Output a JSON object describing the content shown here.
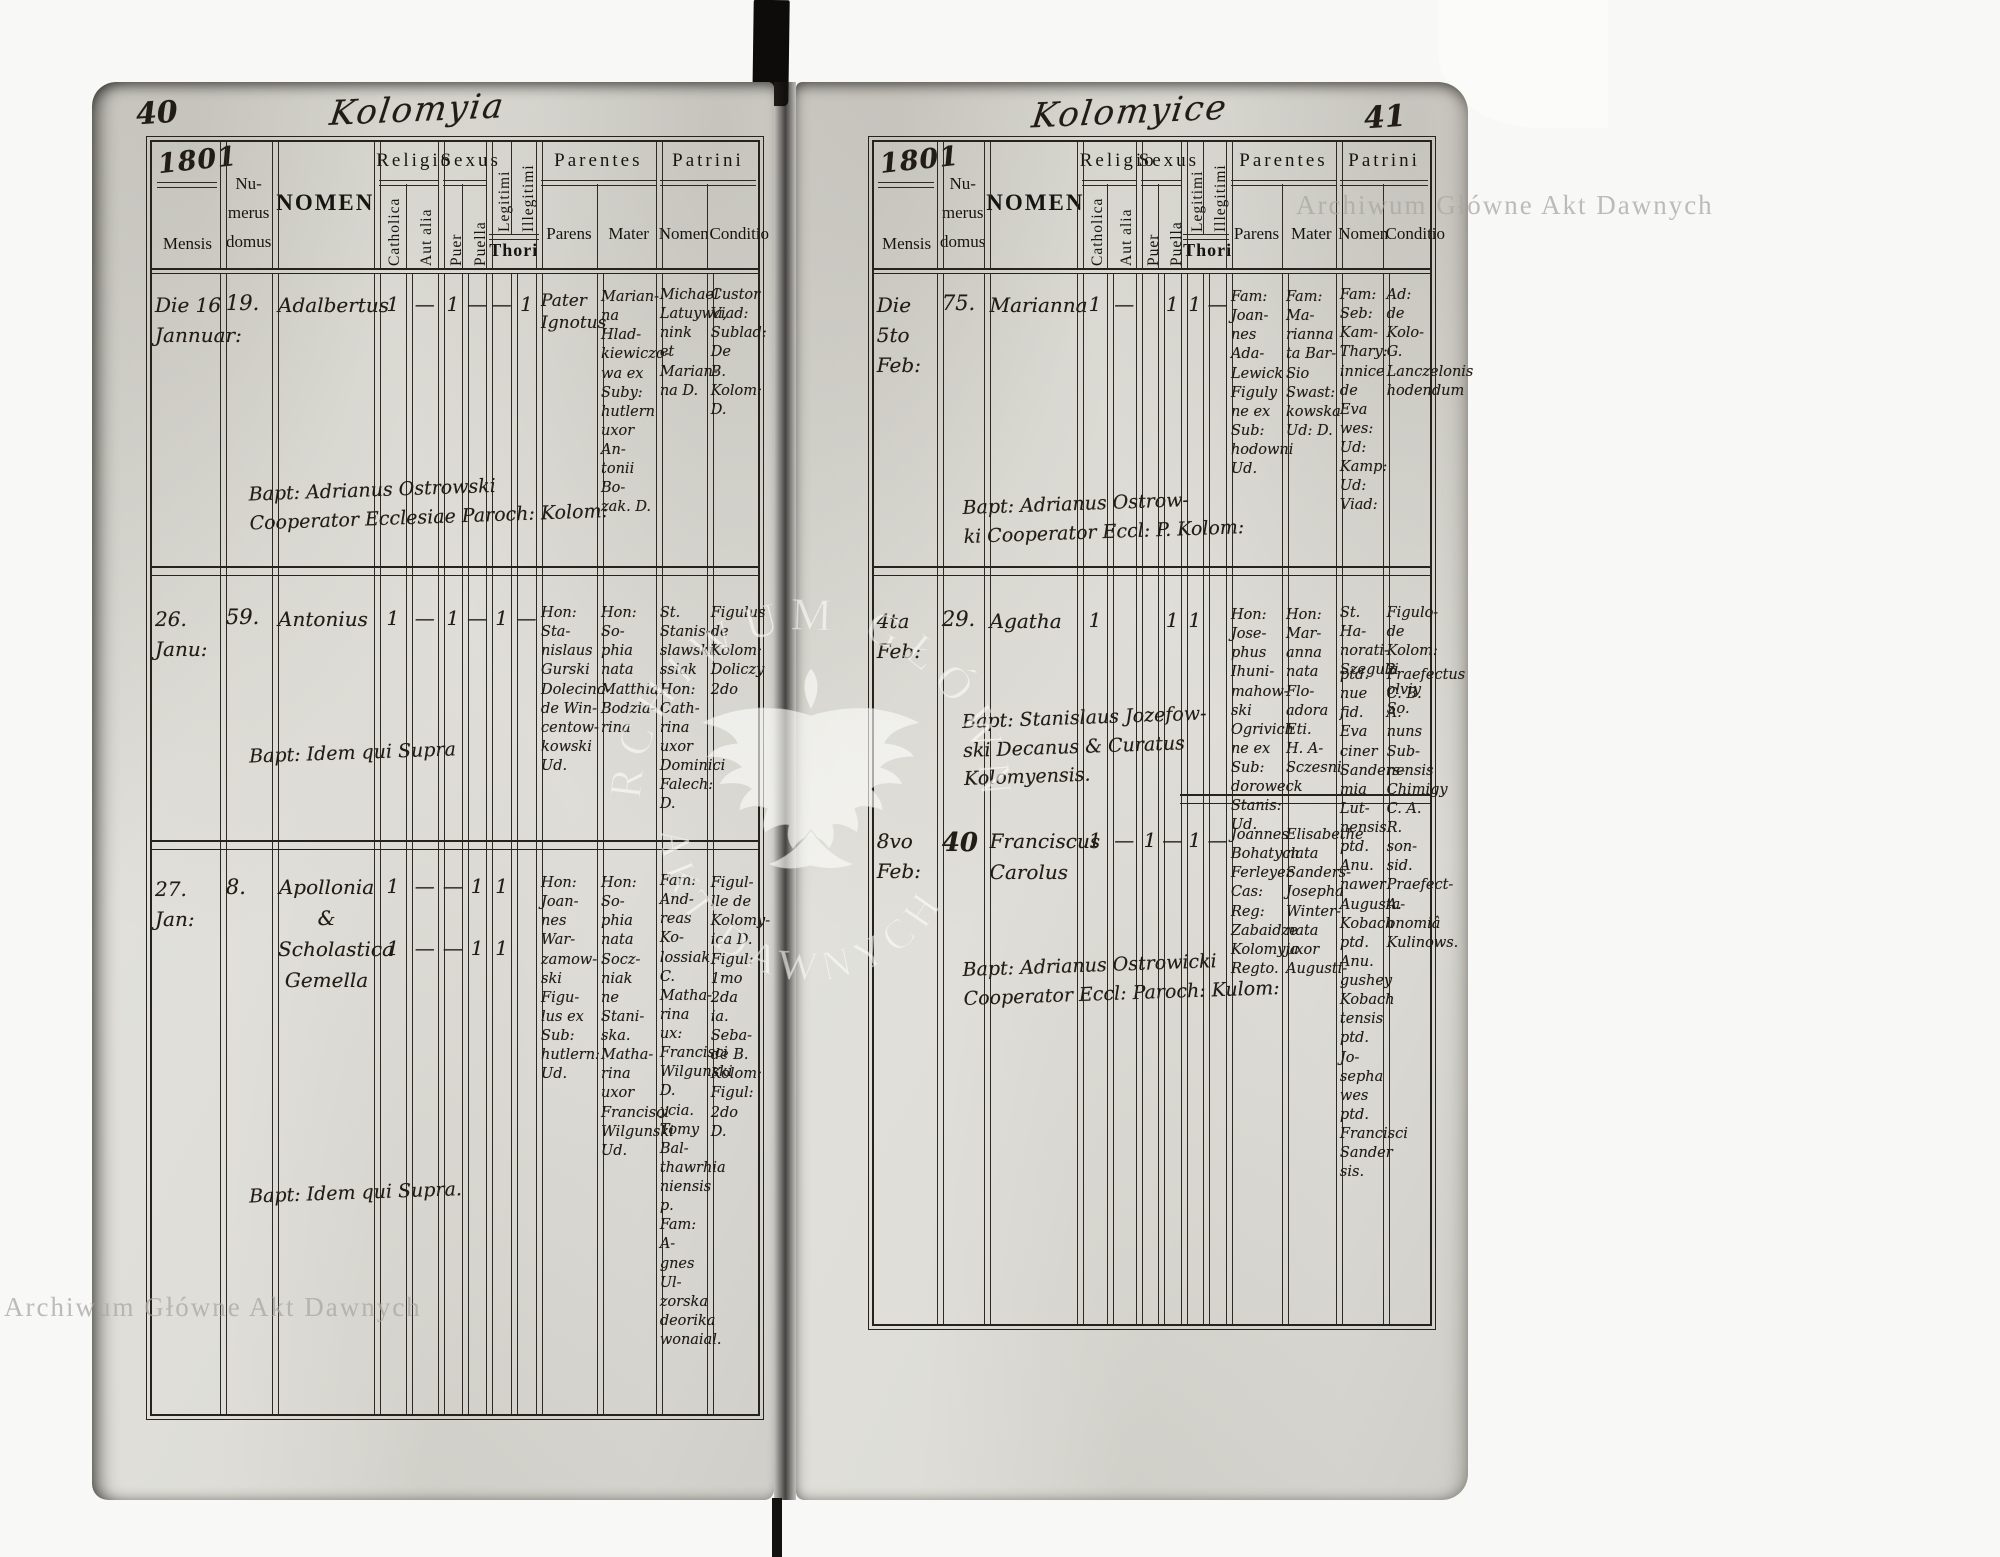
{
  "document": {
    "watermark_text": "Archiwum Główne Akt Dawnych"
  },
  "headers": {
    "mensis": "Mensis",
    "numerus": "Nu-\nmerus\ndomus",
    "nomen": "NOMEN",
    "religio": "Religio",
    "catholica": "Catholica",
    "aut_alia": "Aut alia",
    "sexus": "Sexus",
    "puer": "Puer",
    "puella": "Puella",
    "legitimi": "Legitimi",
    "illegitimi": "Illegitimi",
    "thori": "Thori",
    "parentes": "Parentes",
    "parens": "Parens",
    "mater": "Mater",
    "patrini": "Patrini",
    "patrini_nomen": "Nomen",
    "conditio": "Conditio"
  },
  "left_page": {
    "page_number": "40",
    "title": "Kolomyia",
    "year": "1801",
    "entries": [
      {
        "date": "Die 16\nJannuar:",
        "house": "19.",
        "name": "Adalbertus",
        "marks": {
          "catholica": "1",
          "aut_alia": "—",
          "puer": "1",
          "puella": "—",
          "legitimi": "—",
          "illegitimi": "1"
        },
        "parens": "Pater\nIgnotus",
        "mater": "Marian-\nna Hlad-\nkiewiczo-\nwa ex\nSuby:\nhutlern\nuxor An-\ntonii Bo-\nzak. D.",
        "patrini_nomen": "Michael\nLatuywa,\nnink et\nMarian-\nna D.",
        "patrini_conditio": "Custor\nViad:\nSublad:\nDe\nB. Kolom:\nD.",
        "bapt_note": "Bapt: Adrianus Ostrowski\nCooperator Ecclesiae Paroch: Kolom:"
      },
      {
        "date": "26.\nJanu:",
        "house": "59.",
        "name": "Antonius",
        "marks": {
          "catholica": "1",
          "aut_alia": "—",
          "puer": "1",
          "puella": "—",
          "legitimi": "1",
          "illegitimi": "—"
        },
        "parens": "Hon: Sta-\nnislaus\nGurski\nDolecino-\nde Win-\ncentow-\nkowski\nUd.",
        "mater": "Hon: So-\nphia\nnata\nMatthia\nBodzia-\nrina",
        "patrini_nomen": "St. Stanis-\nslawski\nssiak\nHon: Cath-\nrina uxor\nDominici\nFalech: D.",
        "patrini_conditio": "Figulus\nde\nKolom:\nDoliczy\n2do",
        "bapt_note": "Bapt: Idem qui Supra"
      },
      {
        "date": "27.\nJan:",
        "house": "8.",
        "name": "Apollonia\n&\nScholastica\nGemella",
        "marks": {
          "catholica": "1",
          "aut_alia": "—",
          "puer": "—",
          "puella": "1",
          "legitimi": "1",
          "illegitimi": ""
        },
        "marks2": {
          "catholica": "1",
          "aut_alia": "—",
          "puer": "—",
          "puella": "1",
          "legitimi": "1",
          "illegitimi": ""
        },
        "parens": "Hon: Joan-\nnes War-\nzamow-\nski Figu-\nlus ex\nSub:\nhutlern:\nUd.",
        "mater": "Hon: So-\nphia nata\nSocz-\nniak\nne Stani-\nska.\nMatha-\nrina uxor\nFrancisci\nWilgunski\nUd.",
        "patrini_nomen": "Fam: And-\nreas Ko-\nlossiak C.\nMatha-\nrina ux:\nFrancisci\nWilgunski\nD.\nycia.\nTomy Bal-\nthawrhia\nniensis p.\nFam: A-\ngnes Ul-\nzorska\ndeorika\nwonaial.",
        "patrini_conditio": "Figul-\nlle de\nKolomy-\nica D.\nFigul:\n1mo\n2da\nia.\nSeba-\nde B.\nKolom:\nFigul:\n2do\nD.",
        "bapt_note": "Bapt: Idem qui Supra."
      }
    ]
  },
  "right_page": {
    "page_number": "41",
    "title": "Kolomyice",
    "year": "1801",
    "entries": [
      {
        "date": "Die 5to\nFeb:",
        "house": "75.",
        "name": "Marianna",
        "marks": {
          "catholica": "1",
          "aut_alia": "—",
          "puer": "",
          "puella": "1",
          "legitimi": "1",
          "illegitimi": "—"
        },
        "parens": "Fam: Joan-\nnes Ada-\nLewick\nFiguly\nne ex Sub:\nhodowni\nUd.",
        "mater": "Fam: Ma-\nrianna\nta Bar-\nSio Swast:\nkowska\nUd: D.",
        "patrini_nomen": "Fam: Seb:\nKam-\nThary:\ninnice\nde Eva\nwes: Ud:\nKamp: Ud: Viad:",
        "patrini_conditio": "Ad: de Kolo-\nG.\nLanczelonis\nhodendum",
        "bapt_note": "Bapt: Adrianus Ostrow-\nki Cooperator Eccl: P. Kolom:"
      },
      {
        "date": "4ta\nFeb:",
        "house": "29.",
        "name": "Agatha",
        "marks": {
          "catholica": "1",
          "aut_alia": "",
          "puer": "",
          "puella": "1",
          "legitimi": "1",
          "illegitimi": ""
        },
        "parens": "Hon: Jose-\nphus Ihuni-\nmahow-\nski\nOgrivich\nne ex Sub:\ndoroweck\nStanis: Ud.",
        "mater": "Hon: Mar-\nanna\nnata Flo-\nadora Eti.\nH. A-\nSczesni",
        "patrini_nomen": "St. Ha-\nnorati-\nSzegulii",
        "patrini_conditio": "Figulo-\nde Kolom:\n2 olviy\nSo.",
        "bapt_note": "Bapt: Stanislaus Jozefow-\nski Decanus & Curatus\nKolomyensis."
      },
      {
        "date": "8vo\nFeb:",
        "house": "40",
        "name": "Franciscus\nCarolus",
        "marks": {
          "catholica": "1",
          "aut_alia": "—",
          "puer": "1",
          "puella": "—",
          "legitimi": "1",
          "illegitimi": "—"
        },
        "parens": "Joannes\nBohatych\nFerleyer\nCas: Reg:\nZabaidze\nKolomyja\nRegto.",
        "mater": "Elisabethe\nnata\nSanders-\nJosepha\nWinter-\nnata uxor\nAugusti-",
        "patrini_nomen": "ptd. nue\nfid. Eva\nciner\nSanders-\nmia Lut-\nnensis\nptd. Anu.\nnawer\nAugusta-\nKobach\nptd. Anu.\ngushey\nKobach\ntensis\nptd. Jo-\nsepha\nwes ptd.\nFrancisci\nSander\nsis.",
        "patrini_conditio": "Praefectus\nC. B. A.\nnuns Sub-\nnensis\nChimigy\nC. A. R.\nson-\nsid.\nPraefect-\nA. onomiâ\nKulinows.",
        "bapt_note": "Bapt: Adrianus Ostrowicki\nCooperator Eccl: Paroch: Kulom:"
      }
    ]
  }
}
